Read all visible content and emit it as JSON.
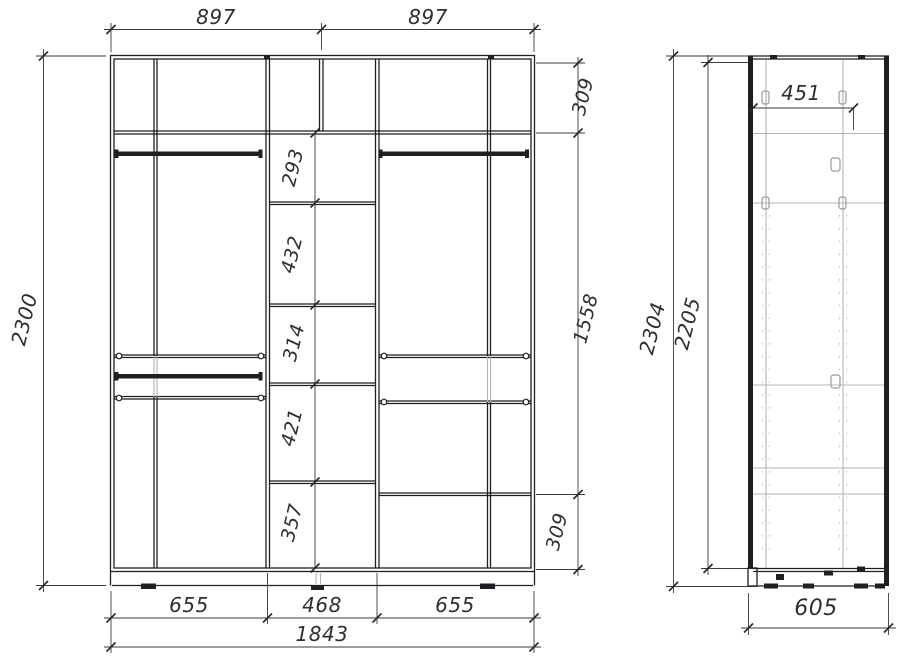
{
  "front_view": {
    "top_widths": [
      "897",
      "897"
    ],
    "overall_height": "2300",
    "right_heights": [
      "309",
      "1558",
      "309"
    ],
    "center_shelf_heights": [
      "293",
      "432",
      "314",
      "421",
      "357"
    ],
    "section_widths": [
      "655",
      "468",
      "655"
    ],
    "overall_width": "1843"
  },
  "side_view": {
    "overall_height": "2304",
    "interior_height": "2205",
    "top_shelf_depth": "451",
    "overall_depth": "605"
  },
  "colors": {
    "carcass_line": "#1f1f23",
    "secondary_line": "#b4b4bc",
    "dimension_line": "#3a3a40",
    "dimension_text": "#2e2e33"
  }
}
